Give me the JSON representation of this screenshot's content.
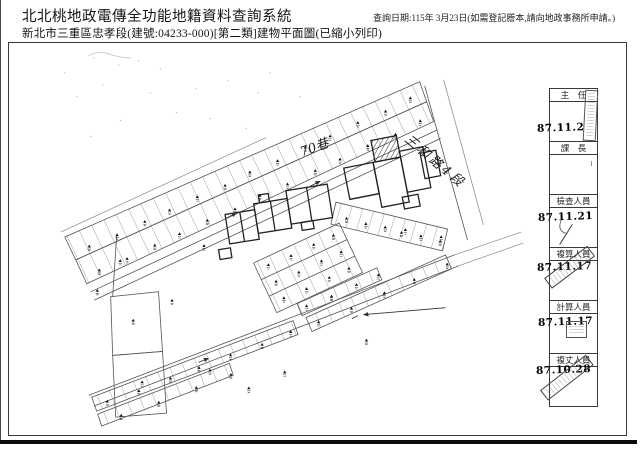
{
  "header": {
    "title": "北北桃地政電傳全功能地籍資料查詢系統",
    "subtitle": "新北市三重區忠孝段(建號:04233-000)[第二類]建物平面圖(已縮小列印)",
    "query_date_note": "查詢日期:115年 3月23日(如需登記謄本,請向地政事務所申請。)"
  },
  "map": {
    "annotations": {
      "lane": "70巷",
      "road": "三和路4段"
    }
  },
  "approval_strip": {
    "sections": [
      {
        "label": "主　任",
        "date": "87.11.2"
      },
      {
        "label": "課　長",
        "date": ""
      },
      {
        "label": "檢查人員",
        "date": "87.11.21"
      },
      {
        "label": "複算人員",
        "date": "87.11.17"
      },
      {
        "label": "計算人員",
        "date": "87.11.17"
      },
      {
        "label": "複丈人員",
        "date": "87.10.28"
      }
    ]
  }
}
